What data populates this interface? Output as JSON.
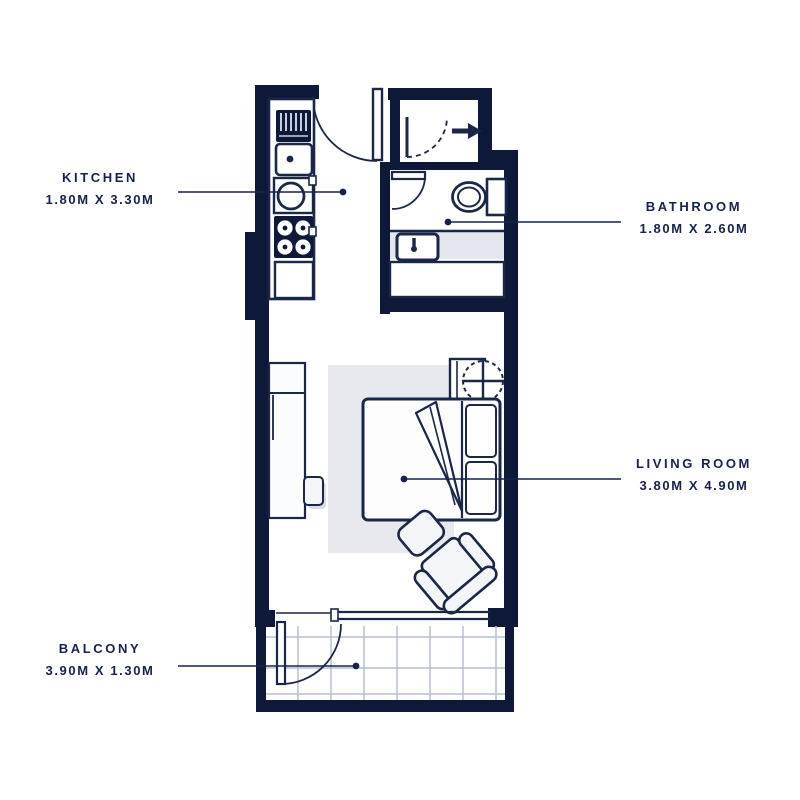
{
  "plan_title": "Studio apartment floor plan",
  "rooms": {
    "kitchen": {
      "name": "KITCHEN",
      "size": "1.80M X 3.30M"
    },
    "bathroom": {
      "name": "BATHROOM",
      "size": "1.80M X 2.60M"
    },
    "living_room": {
      "name": "LIVING ROOM",
      "size": "3.80M X 4.90M"
    },
    "balcony": {
      "name": "BALCONY",
      "size": "3.90M X 1.30M"
    }
  },
  "symbols": [
    "entrance-door",
    "entry-direction-arrow-icon",
    "vestibule-door",
    "bathroom-door",
    "fridge",
    "kitchen-sink",
    "stove-burners",
    "counter",
    "toilet",
    "washbasin",
    "bathtub",
    "wardrobe",
    "stool",
    "rug",
    "double-bed",
    "pillows",
    "blanket",
    "round-table",
    "armchair",
    "ottoman",
    "balcony-door",
    "sliding-window",
    "floor-tiles"
  ],
  "colors": {
    "wall": "#0e1838",
    "line": "#1b2747",
    "text": "#16224a",
    "room_fill": "#ffffff",
    "furniture_fill": "#f4f5f9",
    "rug": "#e8e9ee",
    "counter_band": "#e3e6ed",
    "tile_line": "#b6c0d2"
  }
}
